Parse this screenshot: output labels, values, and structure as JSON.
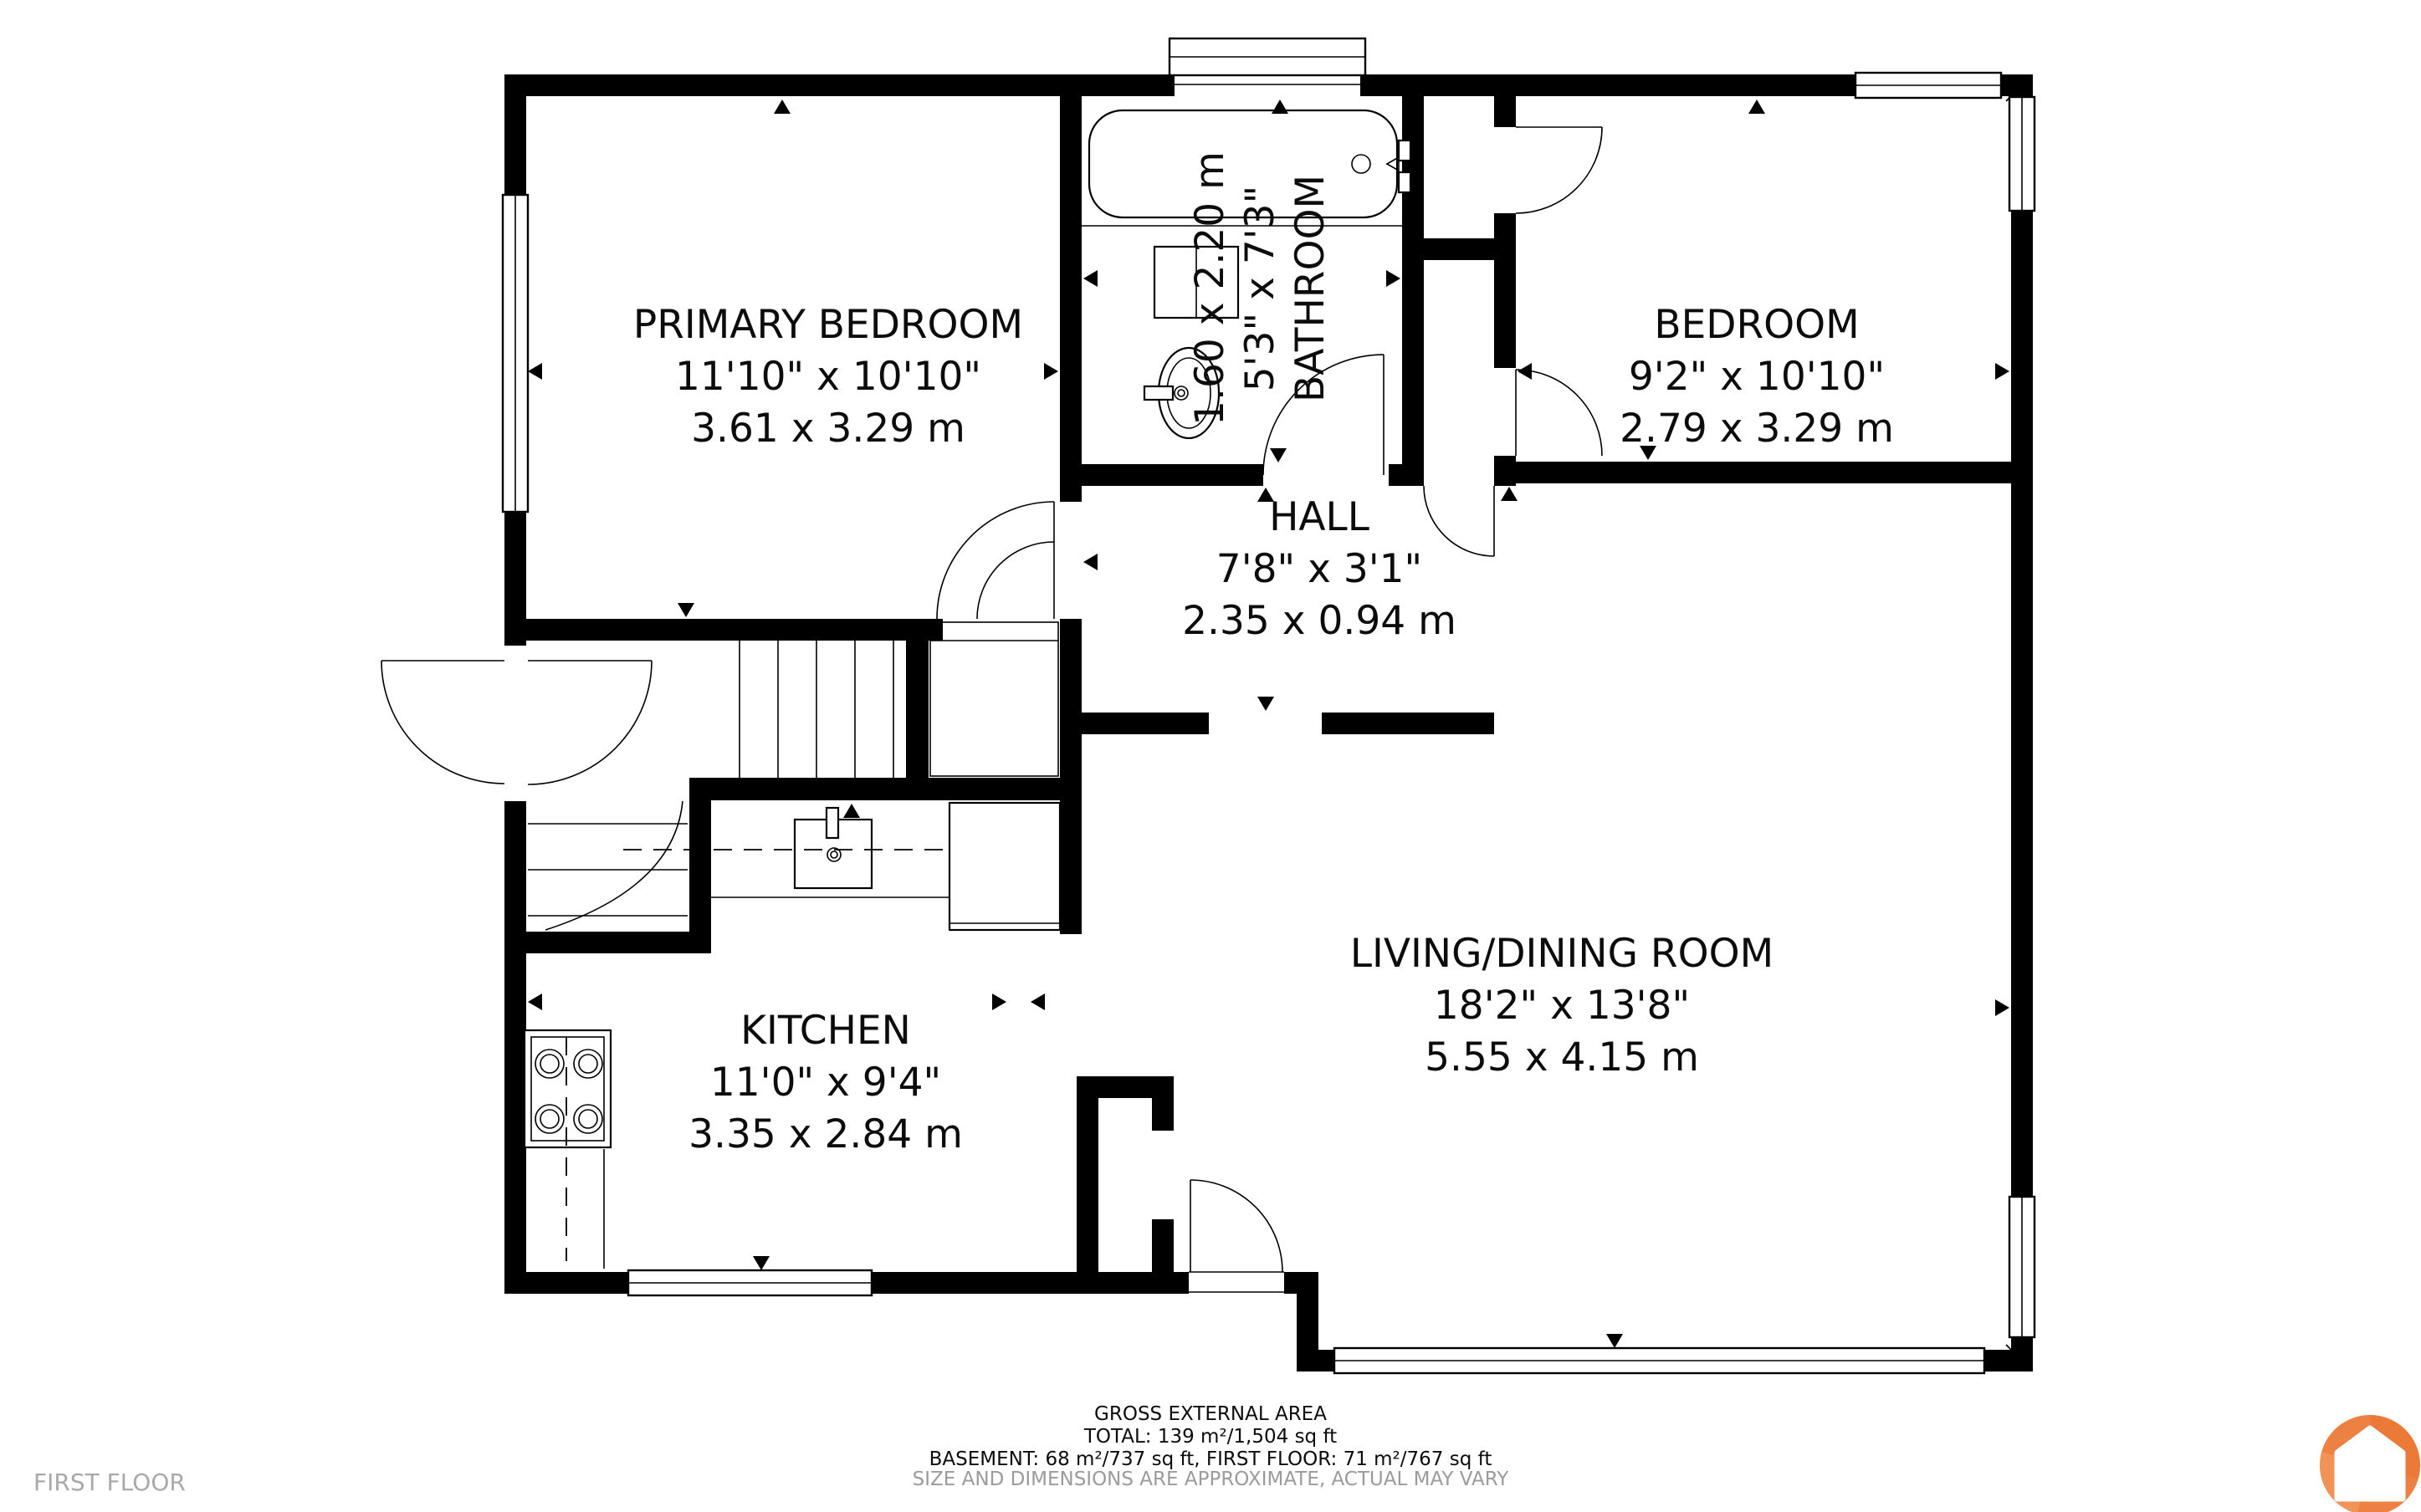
{
  "rooms": [
    {
      "id": "primary-bedroom",
      "name": "PRIMARY BEDROOM",
      "imperial": "11'10\" x 10'10\"",
      "metric": "3.61 x 3.29 m"
    },
    {
      "id": "bathroom",
      "name": "BATHROOM",
      "imperial": "5'3\" x 7'3\"",
      "metric": "1.60 x 2.20 m"
    },
    {
      "id": "bedroom",
      "name": "BEDROOM",
      "imperial": "9'2\" x 10'10\"",
      "metric": "2.79 x 3.29 m"
    },
    {
      "id": "hall",
      "name": "HALL",
      "imperial": "7'8\" x 3'1\"",
      "metric": "2.35 x 0.94 m"
    },
    {
      "id": "kitchen",
      "name": "KITCHEN",
      "imperial": "11'0\" x 9'4\"",
      "metric": "3.35 x 2.84 m"
    },
    {
      "id": "living-dining",
      "name": "LIVING/DINING ROOM",
      "imperial": "18'2\" x 13'8\"",
      "metric": "5.55 x 4.15 m"
    }
  ],
  "footer": {
    "title": "GROSS EXTERNAL AREA",
    "total": "TOTAL: 139 m²/1,504 sq ft",
    "breakdown": "BASEMENT: 68 m²/737 sq ft, FIRST FLOOR: 71 m²/767 sq ft",
    "disclaimer": "SIZE AND DIMENSIONS ARE APPROXIMATE, ACTUAL MAY VARY"
  },
  "floor_label": "FIRST FLOOR",
  "colors": {
    "wall": "#000000",
    "background": "#ffffff",
    "muted_text": "#9b9b9b",
    "logo_orange": "#ED8043",
    "logo_orange_dark": "#E8702D",
    "logo_orange_light": "#F6A36B"
  },
  "logo": {
    "name": "house-logo"
  }
}
